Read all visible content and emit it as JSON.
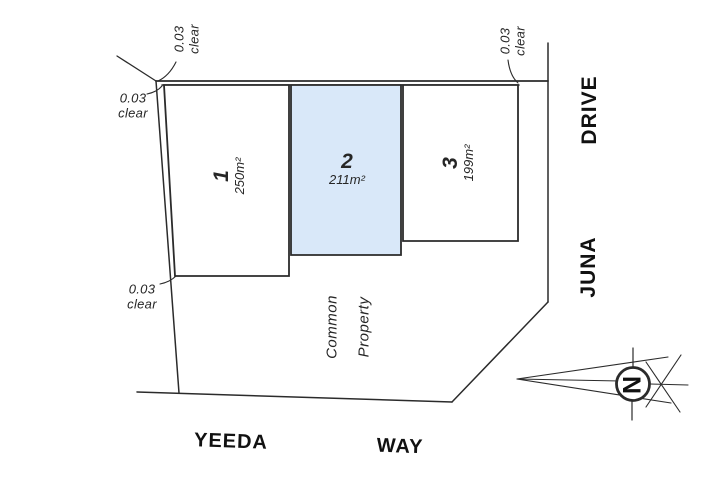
{
  "colors": {
    "highlight_fill": "#d9e8f9",
    "line": "#2b2b2b"
  },
  "clearance_labels": {
    "top_left": {
      "value": "0.03",
      "word": "clear"
    },
    "left": {
      "value": "0.03",
      "word": "clear"
    },
    "bottom_left": {
      "value": "0.03",
      "word": "clear"
    },
    "top_right": {
      "value": "0.03",
      "word": "clear"
    }
  },
  "lots": {
    "lot1": {
      "number": "1",
      "area": "250m²"
    },
    "lot2": {
      "number": "2",
      "area": "211m²"
    },
    "lot3": {
      "number": "3",
      "area": "199m²"
    }
  },
  "common_property": {
    "line1": "Common",
    "line2": "Property"
  },
  "streets": {
    "bottom_name": "YEEDA",
    "bottom_type": "WAY",
    "right_name": "JUNA",
    "right_type": "DRIVE"
  },
  "compass": {
    "north_label": "N"
  }
}
